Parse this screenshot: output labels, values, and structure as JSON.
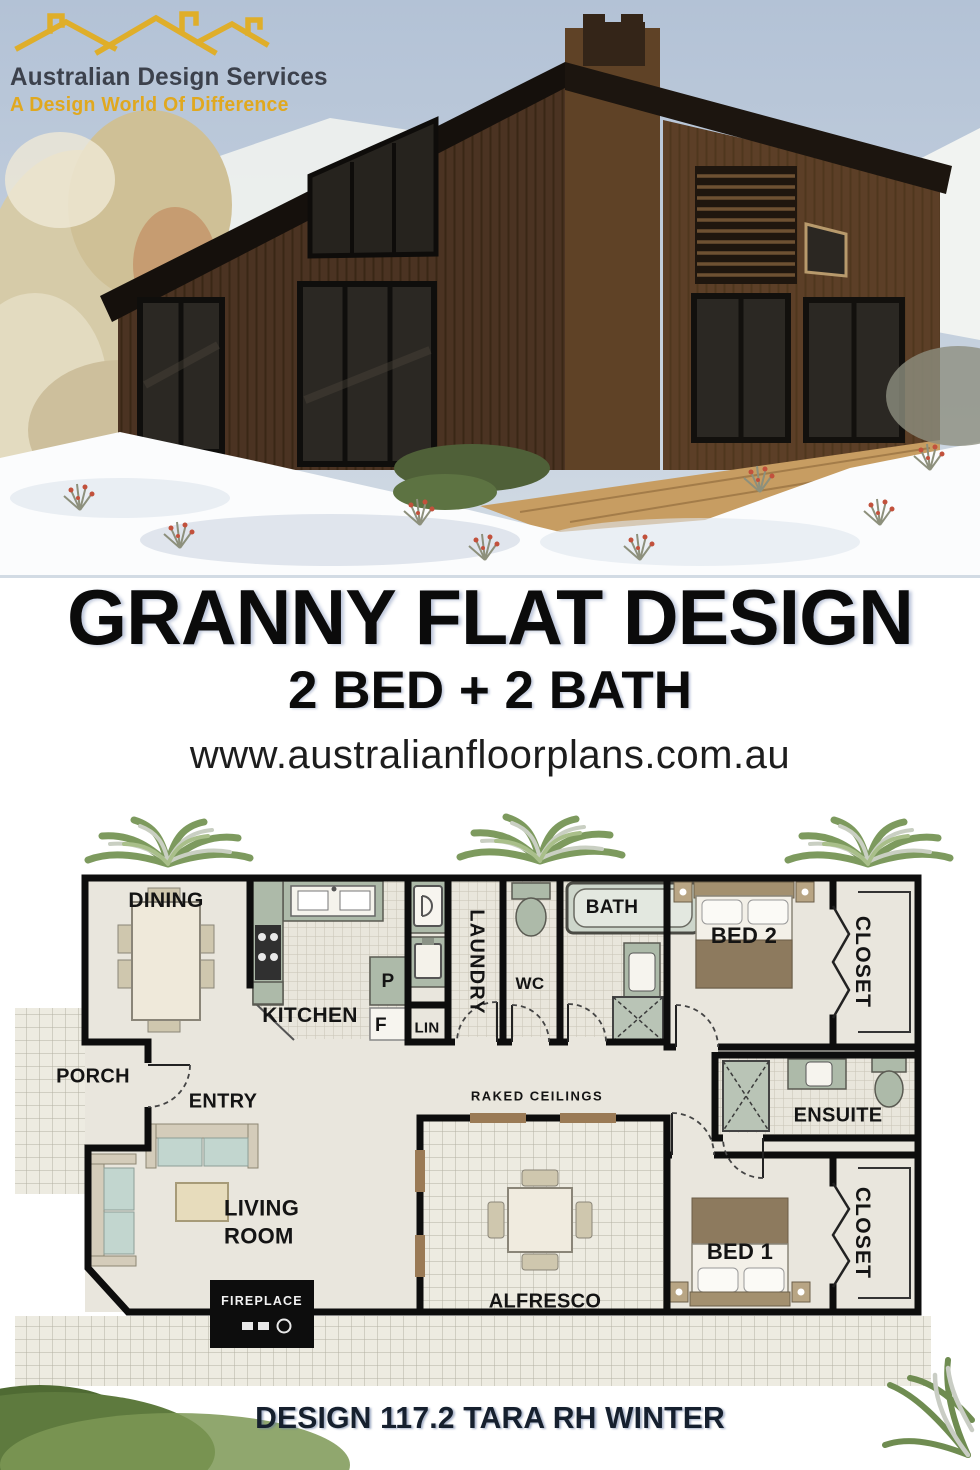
{
  "brand": {
    "name": "Australian Design Services",
    "tagline": "A Design World Of Difference",
    "logo_icon": "rooflines-icon",
    "name_color": "#3c414c",
    "tagline_color": "#e0a81f"
  },
  "headline": {
    "title": "GRANNY FLAT DESIGN",
    "subtitle": "2 BED + 2 BATH",
    "website": "www.australianfloorplans.com.au"
  },
  "floor_plan": {
    "ceiling_note": "RAKED CEILINGS",
    "rooms": {
      "dining": "DINING",
      "kitchen": "KITCHEN",
      "pantry": "P",
      "fridge": "F",
      "linen": "LIN",
      "laundry": "LAUNDRY",
      "wc": "WC",
      "bath": "BATH",
      "bed2": "BED 2",
      "closet_bed2": "CLOSET",
      "porch": "PORCH",
      "entry": "ENTRY",
      "ensuite": "ENSUITE",
      "living_room": "LIVING ROOM",
      "fireplace": "FIREPLACE",
      "alfresco": "ALFRESCO",
      "bed1": "BED 1",
      "closet_bed1": "CLOSET"
    },
    "fixtures": [
      "kitchen-sink",
      "cooktop",
      "pantry",
      "fridge-space",
      "dryer",
      "laundry-tub",
      "toilet",
      "bathtub",
      "vanity",
      "shower",
      "bed",
      "closet-bifold-doors",
      "sofa",
      "coffee-table",
      "dining-table",
      "alfresco-table",
      "fireplace"
    ]
  },
  "footer": {
    "design_code": "DESIGN 117.2 TARA RH WINTER"
  },
  "colors": {
    "brand_yellow": "#dfae2a",
    "wall_black": "#0d0d0d",
    "fixture_sage": "#adbaa9",
    "floor_beige": "#e9e6dd",
    "sky_blue": "#b8c5d7",
    "timber_brown": "#4b3322",
    "headline_text": "#0b0b0b",
    "footer_text": "#16202e"
  }
}
